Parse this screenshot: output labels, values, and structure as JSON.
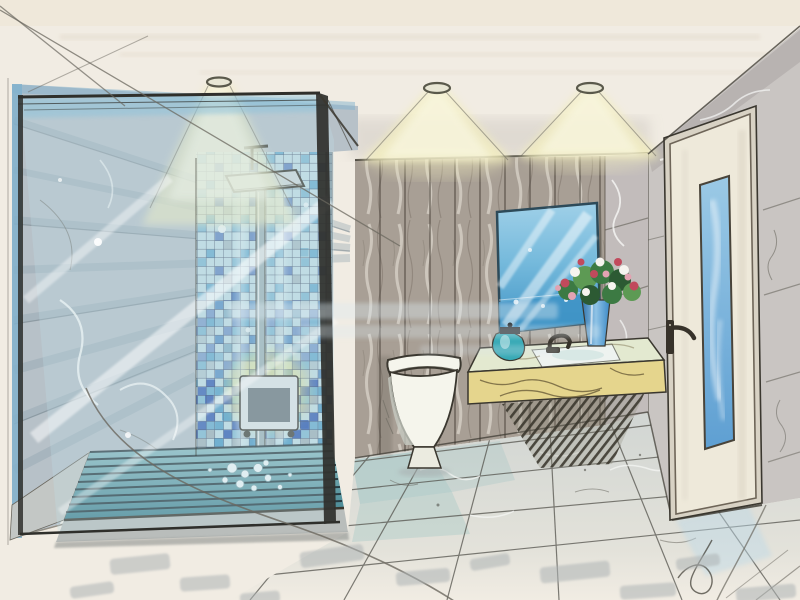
{
  "image": {
    "alt": "Hand-drawn marker and ink perspective sketch of a modern bathroom: glass shower enclosure with blue mosaic tile wall and rain shower on the left, wood plank feature wall with three ceiling spotlights in the center, wall-hung toilet, tilted blue mirror above a yellow marble vanity with sink and flower vase, and a white door with tall blue glass panel in the right marble wall, over large marble floor tiles",
    "medium": "marker sketch",
    "room": "bathroom"
  },
  "objects": {
    "labels": [
      "ceiling spotlight",
      "light cone",
      "glass shower enclosure",
      "blue mosaic tile wall",
      "rain shower set",
      "shower control panel",
      "shower tray",
      "marble feature wall",
      "wood plank wall",
      "wall-hung toilet",
      "vanity mirror",
      "vanity counter with sink",
      "faucet",
      "flower vase",
      "glass jar",
      "glass-panel door",
      "door handle",
      "marble floor tiles",
      "watermark"
    ]
  },
  "palette": {
    "paper": "#f1ece3",
    "paperShade": "#e4dccd",
    "ceilingTint": "#efe7d8",
    "pencil": "#6b685f",
    "ink": "#3a372f",
    "coneYellow": "#f2edbd",
    "coneCore": "#fbf9e8",
    "fixtureMetal": "#5a594b",
    "leftWallBase": "#b7c1c8",
    "leftWallStroke": "#8ba0ac",
    "leftWallBlue": "#82b2cd",
    "veinWhite": "#f7f8f6",
    "crackDark": "#626057",
    "glassTint": "#bfdfe7",
    "glassFrame": "#2f2f2b",
    "glassBlueTop": "#90c3da",
    "mosaicBase": "#c0dbe2",
    "mosaicBlue": "#4f9dc5",
    "mosaicDeep": "#2b55ae",
    "mosaicGray": "#9aaab1",
    "mosaicGrid": "#2a3350",
    "mosaicWhite": "#eef5f6",
    "trayTeal": "#3f818e",
    "trayTealLight": "#8fbec3",
    "traySlat": "#1f2d33",
    "stepGray": "#b9bdbb",
    "floorBase": "#d2d6d3",
    "floorFade": "#f1ece3",
    "floorTeal": "#9fc5c4",
    "floorLine": "#54534d",
    "floorShadow": "#a9b0b1",
    "woodBase": "#a89f95",
    "woodLight": "#d6cfc5",
    "woodDark": "#7b7268",
    "plankLine": "#514941",
    "cornerMarble": "#c2bcbb",
    "toiletWhite": "#f5f5ec",
    "toiletShade": "#c6c9c0",
    "mirrorBlue": "#76badc",
    "mirrorTop": "#9fd0e8",
    "mirrorDeep": "#3e93c5",
    "mirrorFrame": "#2d4a59",
    "counterTop": "#e3e9d0",
    "counterYellow": "#e5d58d",
    "counterVein": "#6b5e3a",
    "hatchDark": "#3b382e",
    "vaseBlue": "#2f80c1",
    "vaseLight": "#8fc3e6",
    "leafGreen": "#3c7a43",
    "leafMid": "#5d9a54",
    "leafDark": "#2c5a33",
    "flowerRed": "#c14a5c",
    "flowerPink": "#e2a3b2",
    "flowerWhite": "#f6f4ef",
    "jarTeal": "#36a9b5",
    "doorFace": "#eee9da",
    "doorFrame": "#6e6558",
    "doorGlassTop": "#9ccae6",
    "doorGlassBot": "#5e9fd2",
    "rightWallBase": "#c9c5c2",
    "rightWallShade": "#b4aead",
    "handleDark": "#37322a",
    "watermark": "#dce9f0",
    "shadowDab": "#aeb4b5",
    "steel": "#9fb3b8",
    "panelFace": "#dde3e4",
    "panelScreen": "#707a80",
    "glowYellow": "#f0e67c"
  }
}
